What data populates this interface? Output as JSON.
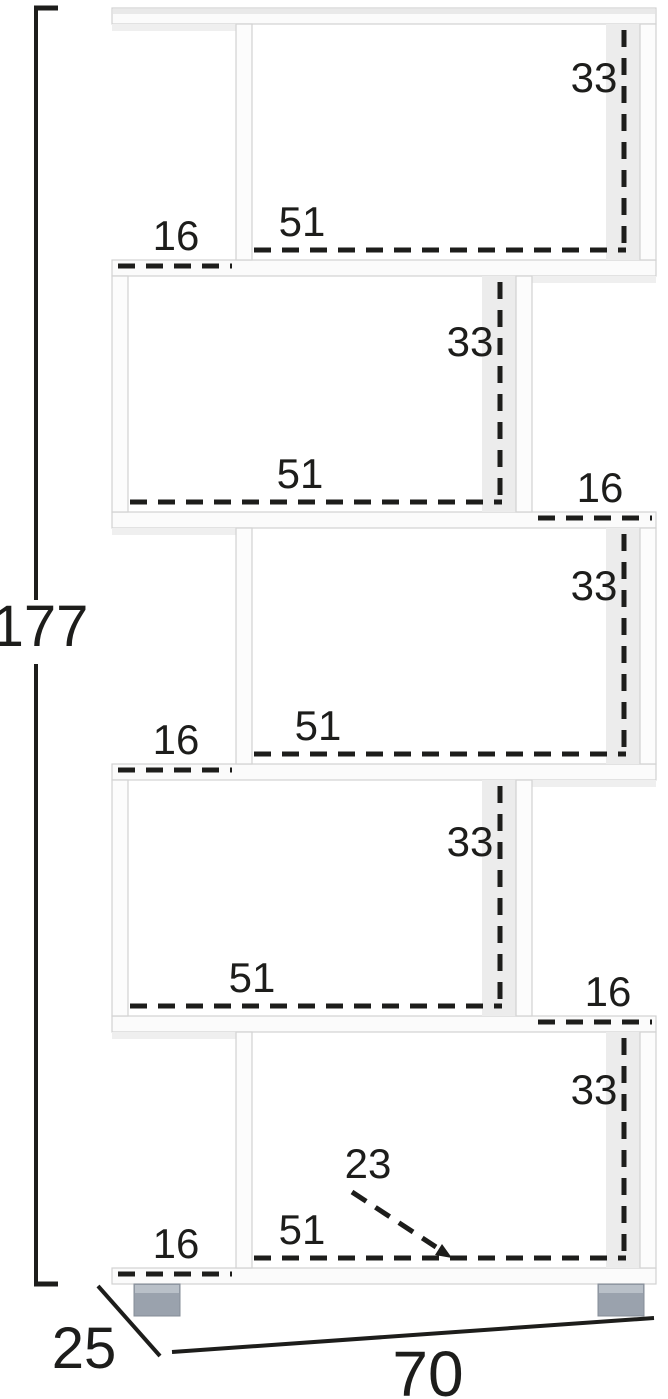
{
  "diagram": {
    "type": "furniture-dimension-diagram",
    "product": "zigzag-bookcase-5-tier",
    "units": "cm"
  },
  "overall": {
    "height": "177",
    "width": "70",
    "depth": "25"
  },
  "tiers": [
    {
      "tier": 1,
      "height": "33",
      "width": "51",
      "offset": "16",
      "offset_side": "left"
    },
    {
      "tier": 2,
      "height": "33",
      "width": "51",
      "offset": "16",
      "offset_side": "right"
    },
    {
      "tier": 3,
      "height": "33",
      "width": "51",
      "offset": "16",
      "offset_side": "left"
    },
    {
      "tier": 4,
      "height": "33",
      "width": "51",
      "offset": "16",
      "offset_side": "right"
    },
    {
      "tier": 5,
      "height": "33",
      "width": "51",
      "offset": "16",
      "offset_side": "left",
      "depth": "23"
    }
  ],
  "colors": {
    "background": "#ffffff",
    "furniture": "#fbfbfb",
    "furniture_edge": "#d2d2d2",
    "interior_shade": "#ececec",
    "dimension_ink": "#1d1d1b",
    "foot_gray": "#9aa2ad",
    "foot_highlight": "#b9c0c8"
  }
}
